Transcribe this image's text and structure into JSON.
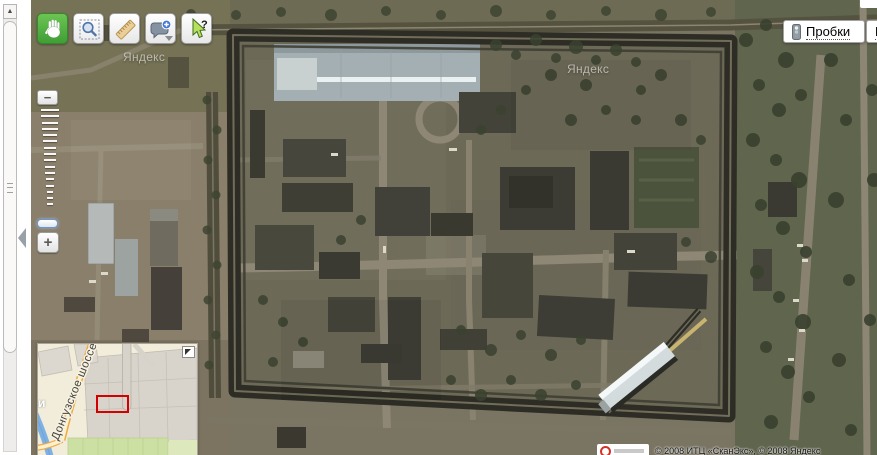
{
  "viewport": {
    "width": 877,
    "height": 455
  },
  "toolbar": {
    "buttons": [
      {
        "icon": "hand-icon",
        "active": true
      },
      {
        "icon": "magnifier-icon",
        "active": false
      },
      {
        "icon": "ruler-icon",
        "active": false
      },
      {
        "icon": "placemark-bubble-icon",
        "active": false,
        "has_dropdown": true
      },
      {
        "icon": "query-cursor-icon",
        "active": false
      }
    ]
  },
  "top_right": {
    "traffic_label": "Пробки",
    "second_button_partial_label": "П"
  },
  "zoom_control": {
    "zoom_out_label": "−",
    "zoom_in_label": "+",
    "tick_count": 16
  },
  "watermarks": [
    "Яндекс",
    "Яндекс"
  ],
  "minimap": {
    "road_label": "Донгузское шоссе",
    "place_label": "и"
  },
  "copyright_text": "© 2008 ИТЦ «СканЭкс», © 2008 Яндекс",
  "scrollbar": {
    "up_arrow": "▲"
  },
  "colors": {
    "active_tool_green": "#4fae3f",
    "viewport_rect_red": "#d40000",
    "minimap_road_orange": "#f0a843"
  }
}
